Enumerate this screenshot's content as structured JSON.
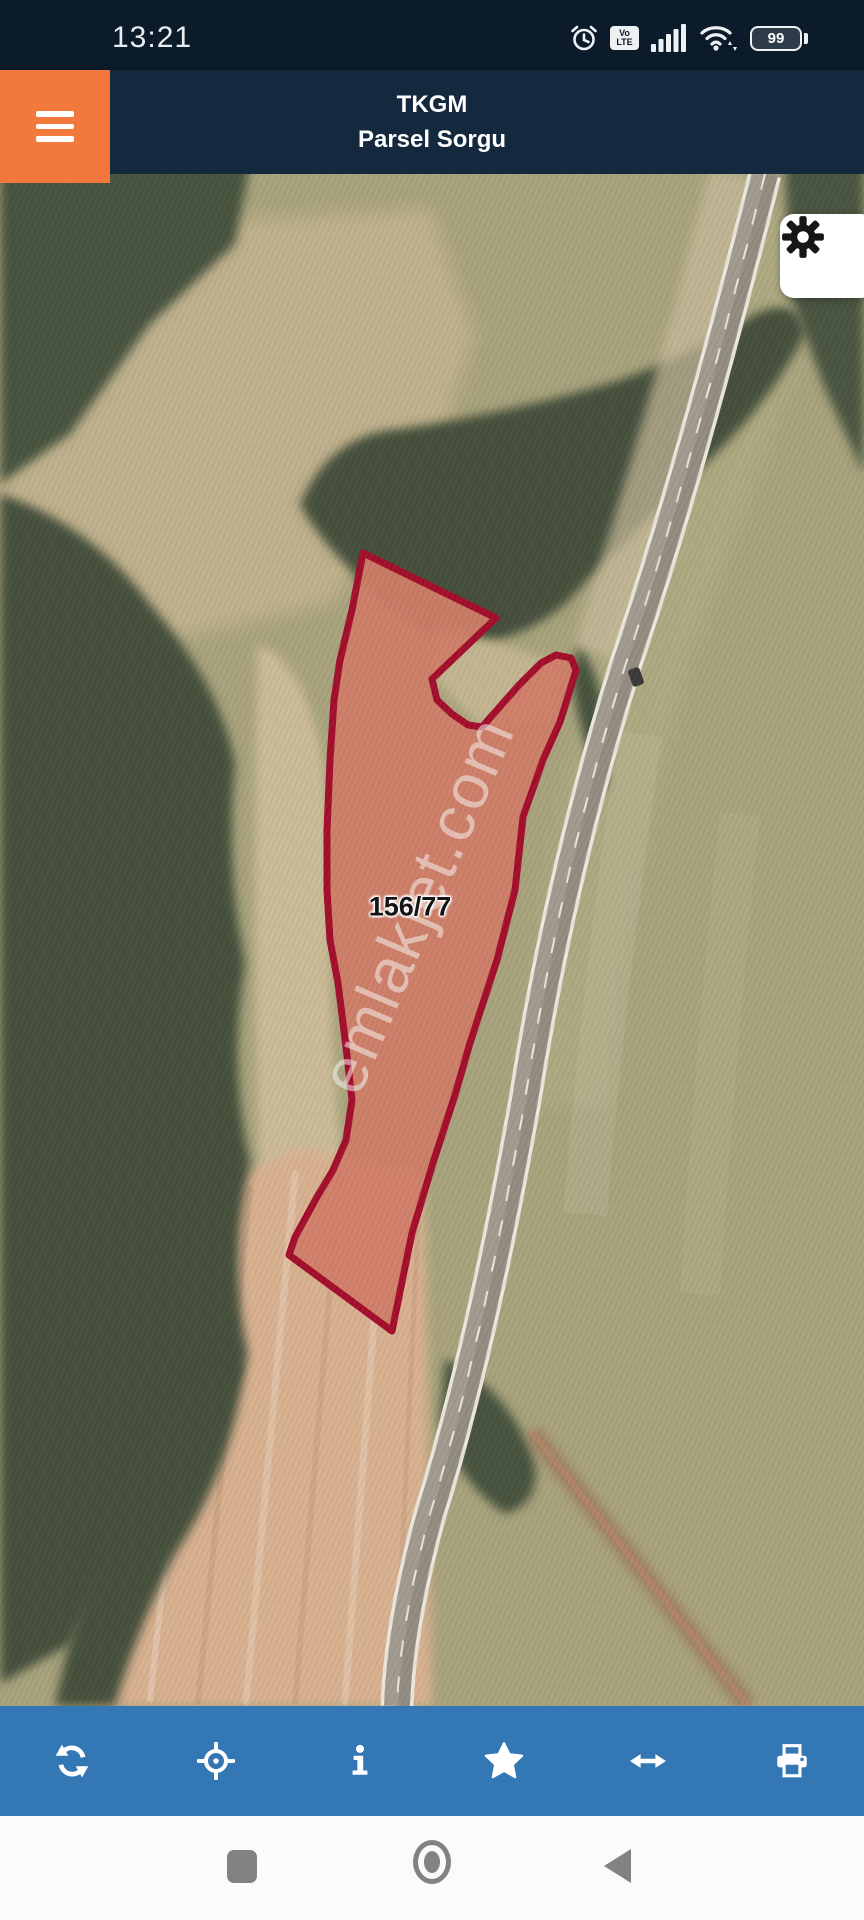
{
  "status_bar": {
    "time": "13:21",
    "volte_top": "Vo",
    "volte_bottom": "LTE",
    "battery_percent": "99",
    "icons": [
      "alarm-icon",
      "volte-badge",
      "signal-icon",
      "wifi-icon",
      "battery-icon"
    ]
  },
  "header": {
    "title": "TKGM",
    "subtitle": "Parsel Sorgu",
    "menu_icon": "hamburger-icon"
  },
  "map": {
    "parcel_label": "156/77",
    "watermark": "emlakjet.com",
    "settings_icon": "gear-icon"
  },
  "toolbar": {
    "items": [
      {
        "icon": "refresh-icon"
      },
      {
        "icon": "locate-crosshair-icon"
      },
      {
        "icon": "info-icon"
      },
      {
        "icon": "star-icon"
      },
      {
        "icon": "resize-horizontal-icon"
      },
      {
        "icon": "print-icon"
      }
    ]
  },
  "nav_bar": {
    "icons": [
      "recents-icon",
      "home-icon",
      "back-icon"
    ]
  },
  "colors": {
    "status_bg": "#0c1b2a",
    "header_bg": "#15293e",
    "menu_bg": "#f2793b",
    "toolbar_bg": "#3377b4",
    "parcel_stroke": "#a30e2c",
    "parcel_fill": "rgba(198,55,40,0.42)",
    "nav_icon": "#828282"
  }
}
